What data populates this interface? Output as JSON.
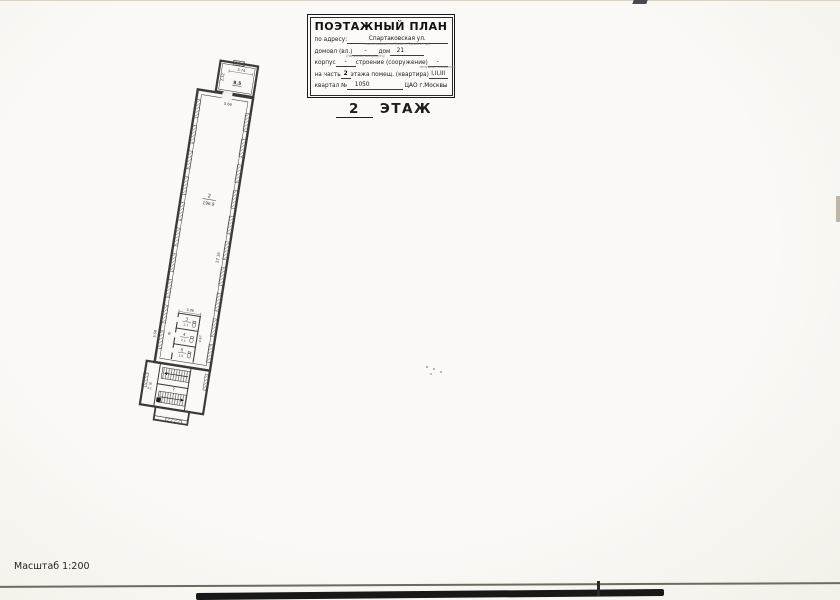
{
  "title_block": {
    "title": "ПОЭТАЖНЫЙ ПЛАН",
    "address_label": "по адресу:",
    "address_value": "Спартаковская ул.",
    "address_sub": "наименование ул. (просп., бульв. и т.д.)",
    "row2_label": "домовл (вл.)",
    "row2_value1": "-",
    "row2_mid": "дом",
    "row2_value2": "21",
    "row2_sub": "(ненужное зачеркнуть)",
    "row3_label": "корпус",
    "row3_value1": "-",
    "row3_mid": "строение (сооружение)",
    "row3_value2": "-",
    "row3_sub": "ненужное зачеркнуть",
    "row4_label": "на часть",
    "row4_value1": "2",
    "row4_mid": "этажа помещ. (квартира)",
    "row4_value2": "I,II,III",
    "row5_label": "квартал №",
    "row5_value1": "1050",
    "row5_right": "ЦАО г.Москвы"
  },
  "floor_label": {
    "number": "2",
    "word": "ЭТАЖ"
  },
  "plan": {
    "top_room": {
      "area": "8.5",
      "dim_width": "3.74",
      "dim_height": "2.32"
    },
    "hall": {
      "number": "2",
      "area": "196.9",
      "dim_height": "27 16",
      "dim_top": "5.66"
    },
    "service": {
      "dim_top": "3.06",
      "dim_left": "5.58",
      "dim_right": "4.67",
      "room3_number": "3",
      "room3_area": "2.1",
      "room4_number": "4",
      "room4_area": "2.1",
      "room5_number": "5",
      "room5_area": "1.5",
      "corridor_number": "6"
    },
    "stair": {
      "hall_number": "7",
      "room_number": "10",
      "room_area": "4.1"
    }
  },
  "footer": {
    "scale": "Масштаб 1:200"
  }
}
